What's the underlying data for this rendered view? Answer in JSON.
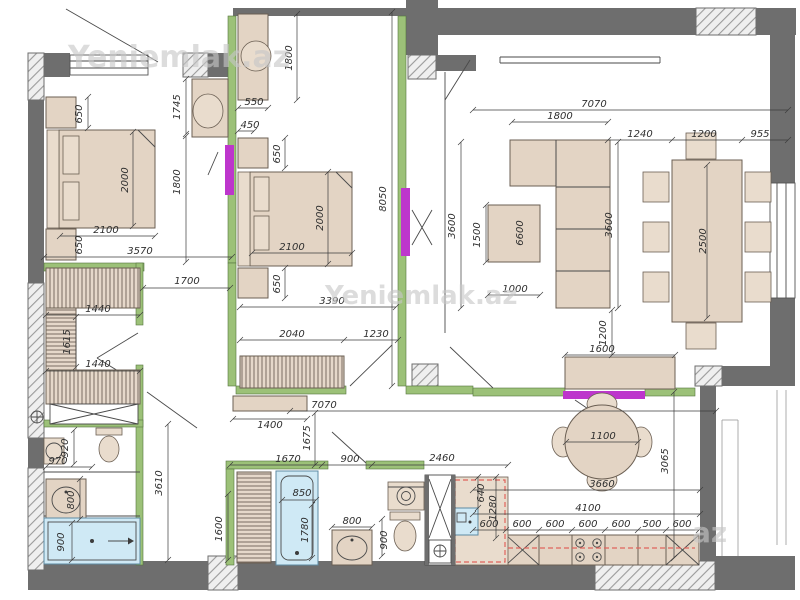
{
  "watermarks": [
    {
      "text": "Yeniemlak.az",
      "x": 163,
      "y": 67,
      "size": 30
    },
    {
      "text": "Yeniemlak.az",
      "x": 408,
      "y": 304,
      "size": 26
    },
    {
      "text": "az",
      "x": 707,
      "y": 542,
      "size": 28
    }
  ],
  "colors": {
    "exterior_wall": "#6e6e6e",
    "pier_hatch": "#9a9a9a",
    "partition_green": "#9cc178",
    "sliding_door_magenta": "#bd36cc",
    "furniture_beige": "#e3d4c4",
    "water_fixture_blue": "#cfe9f5",
    "appliance_outline_red": "#e0635c",
    "dimension_text": "#2f2f2f",
    "watermark_gray": "#c7c7c7"
  },
  "dimensions": [
    {
      "t": "650",
      "x": 82,
      "y": 114,
      "r": -90
    },
    {
      "t": "2000",
      "x": 128,
      "y": 180,
      "r": -90
    },
    {
      "t": "2100",
      "x": 106,
      "y": 233,
      "r": 0
    },
    {
      "t": "650",
      "x": 82,
      "y": 245,
      "r": -90
    },
    {
      "t": "3570",
      "x": 140,
      "y": 254,
      "r": 0
    },
    {
      "t": "1745",
      "x": 180,
      "y": 107,
      "r": -90
    },
    {
      "t": "1800",
      "x": 180,
      "y": 182,
      "r": -90
    },
    {
      "t": "1800",
      "x": 292,
      "y": 58,
      "r": -90
    },
    {
      "t": "550",
      "x": 254,
      "y": 105,
      "r": 0
    },
    {
      "t": "450",
      "x": 250,
      "y": 128,
      "r": 0
    },
    {
      "t": "650",
      "x": 280,
      "y": 154,
      "r": -90
    },
    {
      "t": "2000",
      "x": 323,
      "y": 218,
      "r": -90
    },
    {
      "t": "2100",
      "x": 292,
      "y": 250,
      "r": 0
    },
    {
      "t": "650",
      "x": 280,
      "y": 284,
      "r": -90
    },
    {
      "t": "3390",
      "x": 332,
      "y": 304,
      "r": 0
    },
    {
      "t": "2040",
      "x": 292,
      "y": 337,
      "r": 0
    },
    {
      "t": "1230",
      "x": 376,
      "y": 337,
      "r": 0
    },
    {
      "t": "8050",
      "x": 386,
      "y": 199,
      "r": -90
    },
    {
      "t": "7070",
      "x": 594,
      "y": 107,
      "r": 0
    },
    {
      "t": "1800",
      "x": 560,
      "y": 119,
      "r": 0
    },
    {
      "t": "1240",
      "x": 640,
      "y": 137,
      "r": 0
    },
    {
      "t": "1200",
      "x": 704,
      "y": 137,
      "r": 0
    },
    {
      "t": "955",
      "x": 760,
      "y": 137,
      "r": 0
    },
    {
      "t": "3600",
      "x": 455,
      "y": 226,
      "r": -90
    },
    {
      "t": "3600",
      "x": 612,
      "y": 225,
      "r": -90
    },
    {
      "t": "6600",
      "x": 523,
      "y": 233,
      "r": -90
    },
    {
      "t": "1500",
      "x": 480,
      "y": 235,
      "r": -90
    },
    {
      "t": "1000",
      "x": 515,
      "y": 292,
      "r": 0
    },
    {
      "t": "2500",
      "x": 706,
      "y": 241,
      "r": -90
    },
    {
      "t": "1200",
      "x": 606,
      "y": 333,
      "r": -90
    },
    {
      "t": "1600",
      "x": 602,
      "y": 352,
      "r": 0
    },
    {
      "t": "1100",
      "x": 603,
      "y": 439,
      "r": 0
    },
    {
      "t": "3660",
      "x": 602,
      "y": 487,
      "r": 0
    },
    {
      "t": "3065",
      "x": 668,
      "y": 461,
      "r": -90
    },
    {
      "t": "4100",
      "x": 588,
      "y": 511,
      "r": 0
    },
    {
      "t": "600",
      "x": 489,
      "y": 527,
      "r": 0
    },
    {
      "t": "600",
      "x": 522,
      "y": 527,
      "r": 0
    },
    {
      "t": "600",
      "x": 555,
      "y": 527,
      "r": 0
    },
    {
      "t": "600",
      "x": 588,
      "y": 527,
      "r": 0
    },
    {
      "t": "600",
      "x": 621,
      "y": 527,
      "r": 0
    },
    {
      "t": "500",
      "x": 652,
      "y": 527,
      "r": 0
    },
    {
      "t": "600",
      "x": 682,
      "y": 527,
      "r": 0
    },
    {
      "t": "640",
      "x": 484,
      "y": 493,
      "r": -90
    },
    {
      "t": "1280",
      "x": 496,
      "y": 508,
      "r": -90
    },
    {
      "t": "1400",
      "x": 270,
      "y": 428,
      "r": 0
    },
    {
      "t": "7070",
      "x": 324,
      "y": 408,
      "r": 0
    },
    {
      "t": "1675",
      "x": 310,
      "y": 438,
      "r": -90
    },
    {
      "t": "1670",
      "x": 288,
      "y": 462,
      "r": 0
    },
    {
      "t": "900",
      "x": 350,
      "y": 462,
      "r": 0
    },
    {
      "t": "2460",
      "x": 442,
      "y": 461,
      "r": 0
    },
    {
      "t": "3610",
      "x": 162,
      "y": 483,
      "r": -90
    },
    {
      "t": "1600",
      "x": 222,
      "y": 529,
      "r": -90
    },
    {
      "t": "970",
      "x": 58,
      "y": 464,
      "r": 0
    },
    {
      "t": "920",
      "x": 68,
      "y": 448,
      "r": -90
    },
    {
      "t": "800",
      "x": 74,
      "y": 500,
      "r": -90
    },
    {
      "t": "900",
      "x": 64,
      "y": 542,
      "r": -90
    },
    {
      "t": "1440",
      "x": 98,
      "y": 312,
      "r": 0
    },
    {
      "t": "1615",
      "x": 70,
      "y": 342,
      "r": -90
    },
    {
      "t": "1440",
      "x": 98,
      "y": 367,
      "r": 0
    },
    {
      "t": "1700",
      "x": 187,
      "y": 284,
      "r": 0
    },
    {
      "t": "850",
      "x": 302,
      "y": 496,
      "r": 0
    },
    {
      "t": "1780",
      "x": 308,
      "y": 530,
      "r": -90
    },
    {
      "t": "800",
      "x": 352,
      "y": 524,
      "r": 0
    },
    {
      "t": "900",
      "x": 387,
      "y": 540,
      "r": -90
    }
  ]
}
